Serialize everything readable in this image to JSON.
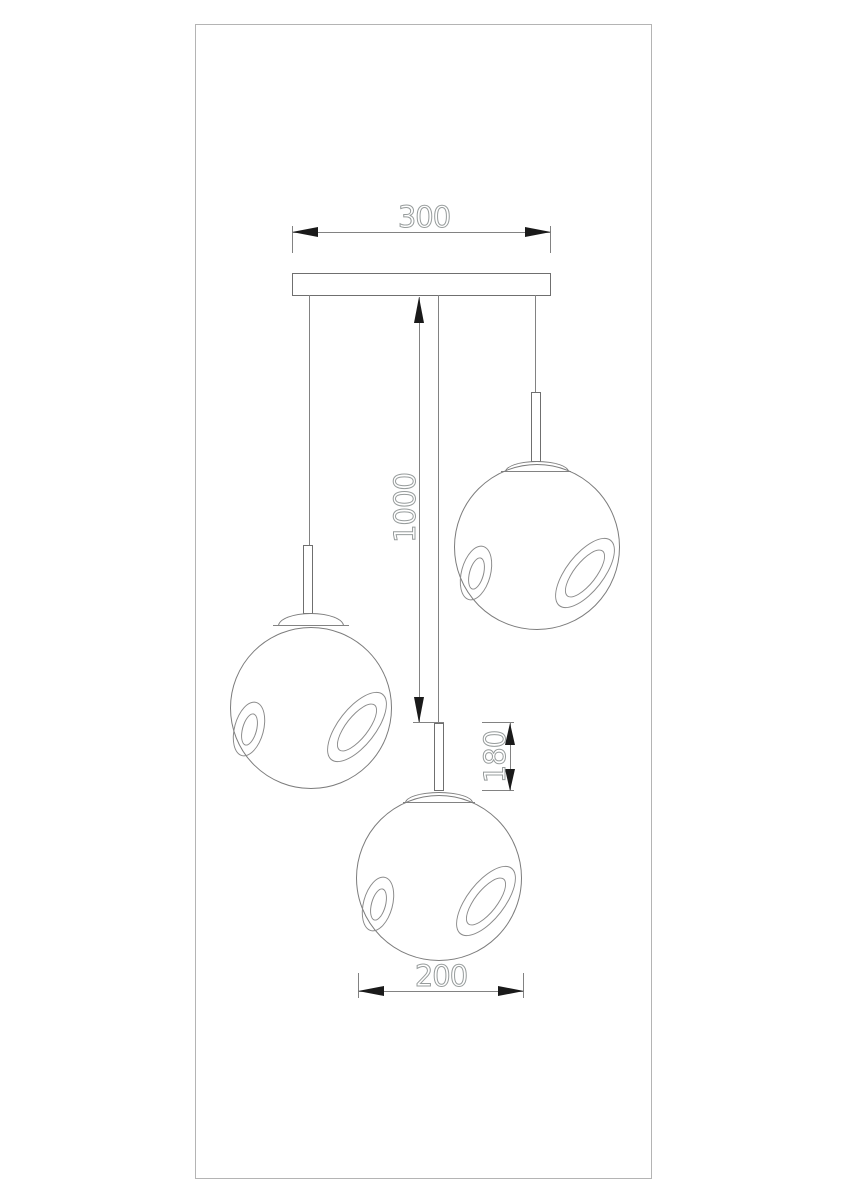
{
  "drawing": {
    "kind": "pendant-lamp-dimensional-drawing",
    "dim_canopy_width": "300",
    "dim_drop_height": "1000",
    "dim_stem_height": "180",
    "dim_shade_diameter": "200"
  },
  "colors": {
    "line": "#7c7c7c",
    "arrowhead": "#1a1a1a",
    "dim_text_outline": "#979c9c",
    "frame": "#b4b4b4",
    "background": "#ffffff"
  }
}
